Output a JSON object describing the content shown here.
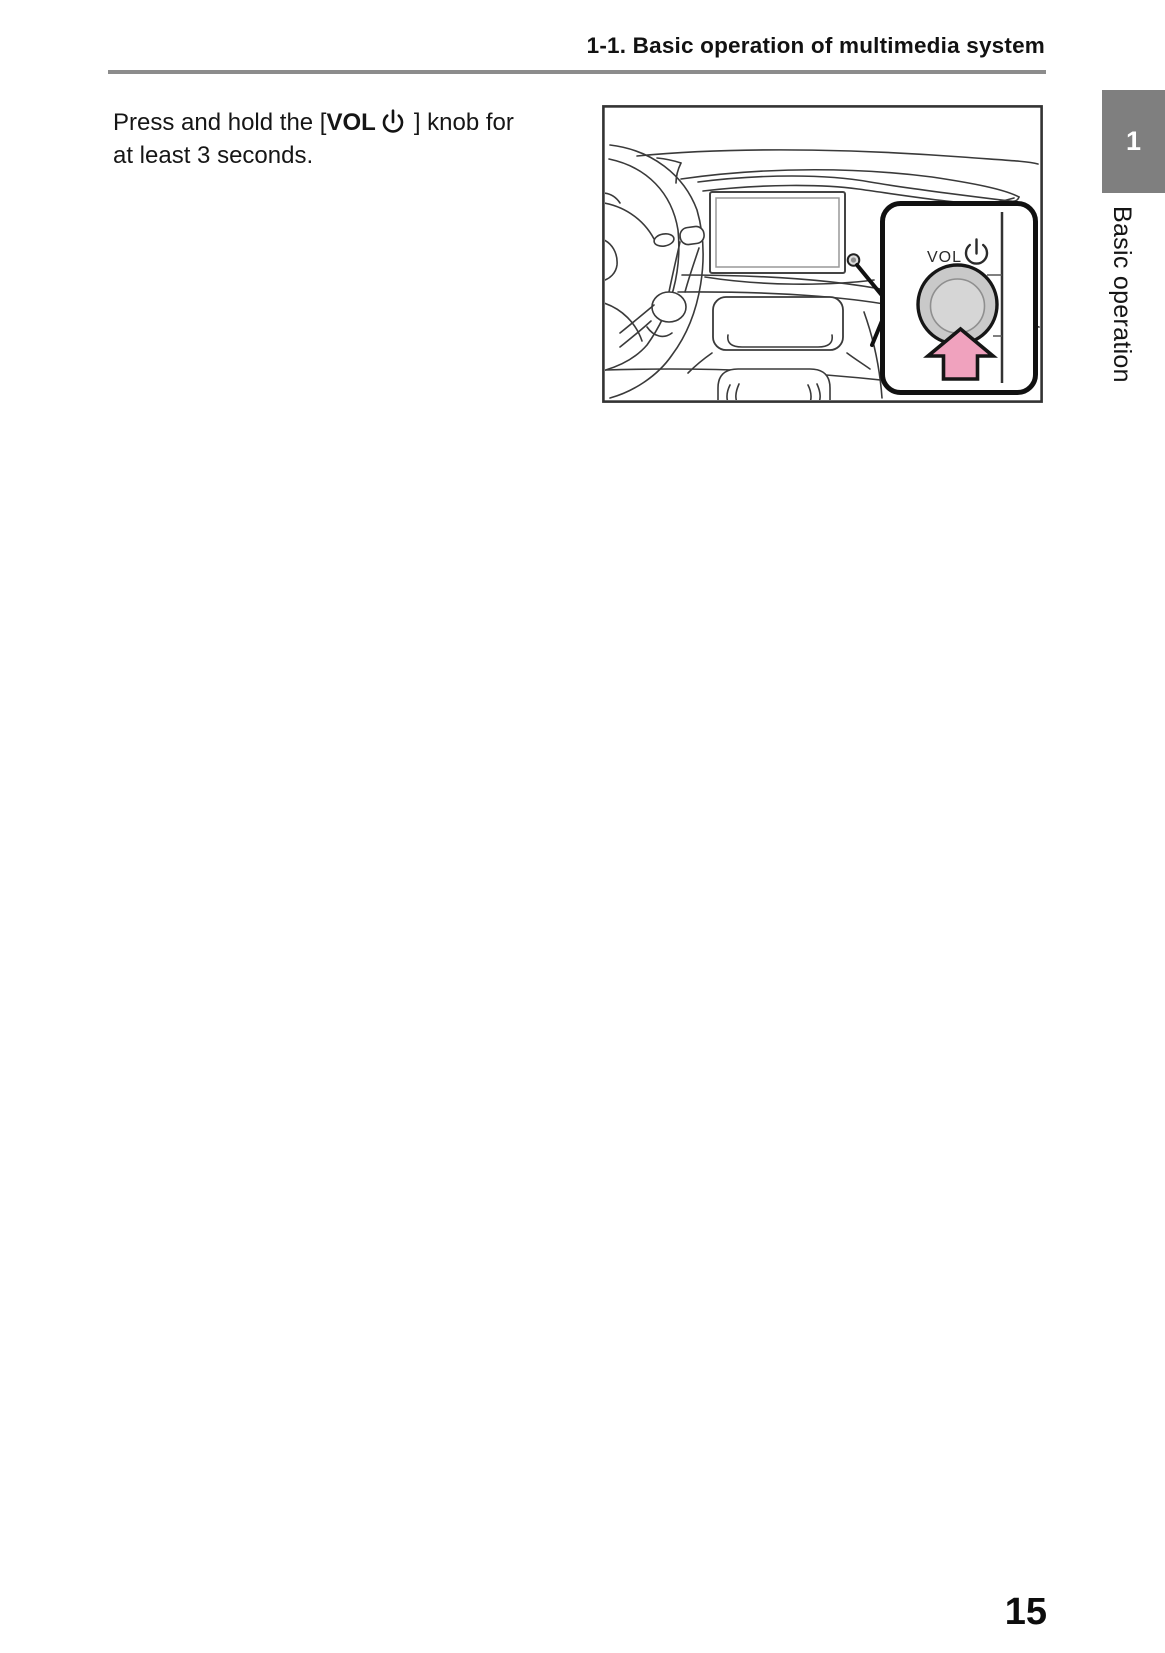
{
  "header": {
    "section_title": "1-1. Basic operation of multimedia system"
  },
  "sidebar_tab": {
    "chapter_number": "1",
    "chapter_title": "Basic operation"
  },
  "content": {
    "instruction": {
      "line1_prefix": "Press and hold the [",
      "knob_label": "VOL",
      "power_icon_name": "power-icon",
      "line1_suffix": "] knob for",
      "line2": "at least 3 seconds."
    },
    "figure": {
      "callout_knob_label": "VOL",
      "callout_power_icon_name": "power-icon"
    }
  },
  "footer": {
    "page_number": "15"
  },
  "colors": {
    "rule_gray": "#8c8c8c",
    "tab_gray": "#7f7f7f",
    "arrow_pink": "#f0a2be",
    "knob_outer_gray": "#c9c9c9",
    "knob_inner_gray": "#d6d6d6",
    "line_art": "#3a3a3a"
  }
}
